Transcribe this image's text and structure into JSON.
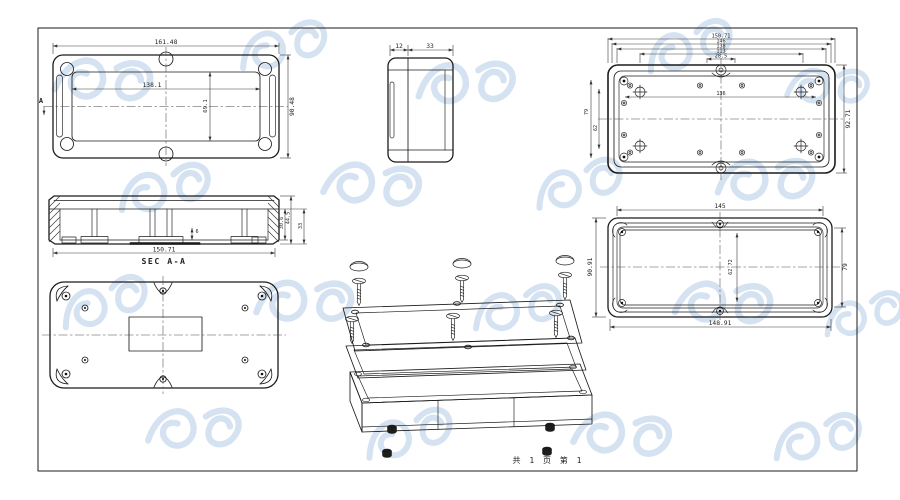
{
  "sheet": {
    "footer": "共 1 页  第 1",
    "paper_color": "#ffffff",
    "line_color": "#1b1b1b",
    "dim_color": "#333333",
    "watermark_color": "#c9dbee"
  },
  "views": {
    "cover_top": {
      "dims": {
        "total_width": "161.48",
        "inner_width": "138.1",
        "inner_height": "69.1",
        "total_height": "90.48"
      },
      "section_marker": "A"
    },
    "side": {
      "dims": {
        "lid": "12",
        "base": "33"
      }
    },
    "base_back": {
      "dims": {
        "stack": [
          "150.71",
          "146",
          "138",
          "113",
          "28.5"
        ],
        "inner_width": "136",
        "right_height": "92.71",
        "outer_left_height": "79",
        "inner_left_height": "62"
      }
    },
    "section": {
      "label": "SEC A-A",
      "dims": {
        "width": "150.71",
        "inner_depth": "30.6",
        "total_depth": "44.5",
        "base_height": "33",
        "boss": "6"
      }
    },
    "lid_inside": {
      "dims": {
        "top_width": "145",
        "bottom_width": "148.91",
        "left_height": "90.91",
        "right_height": "79",
        "inner_height": "62.72"
      }
    }
  }
}
